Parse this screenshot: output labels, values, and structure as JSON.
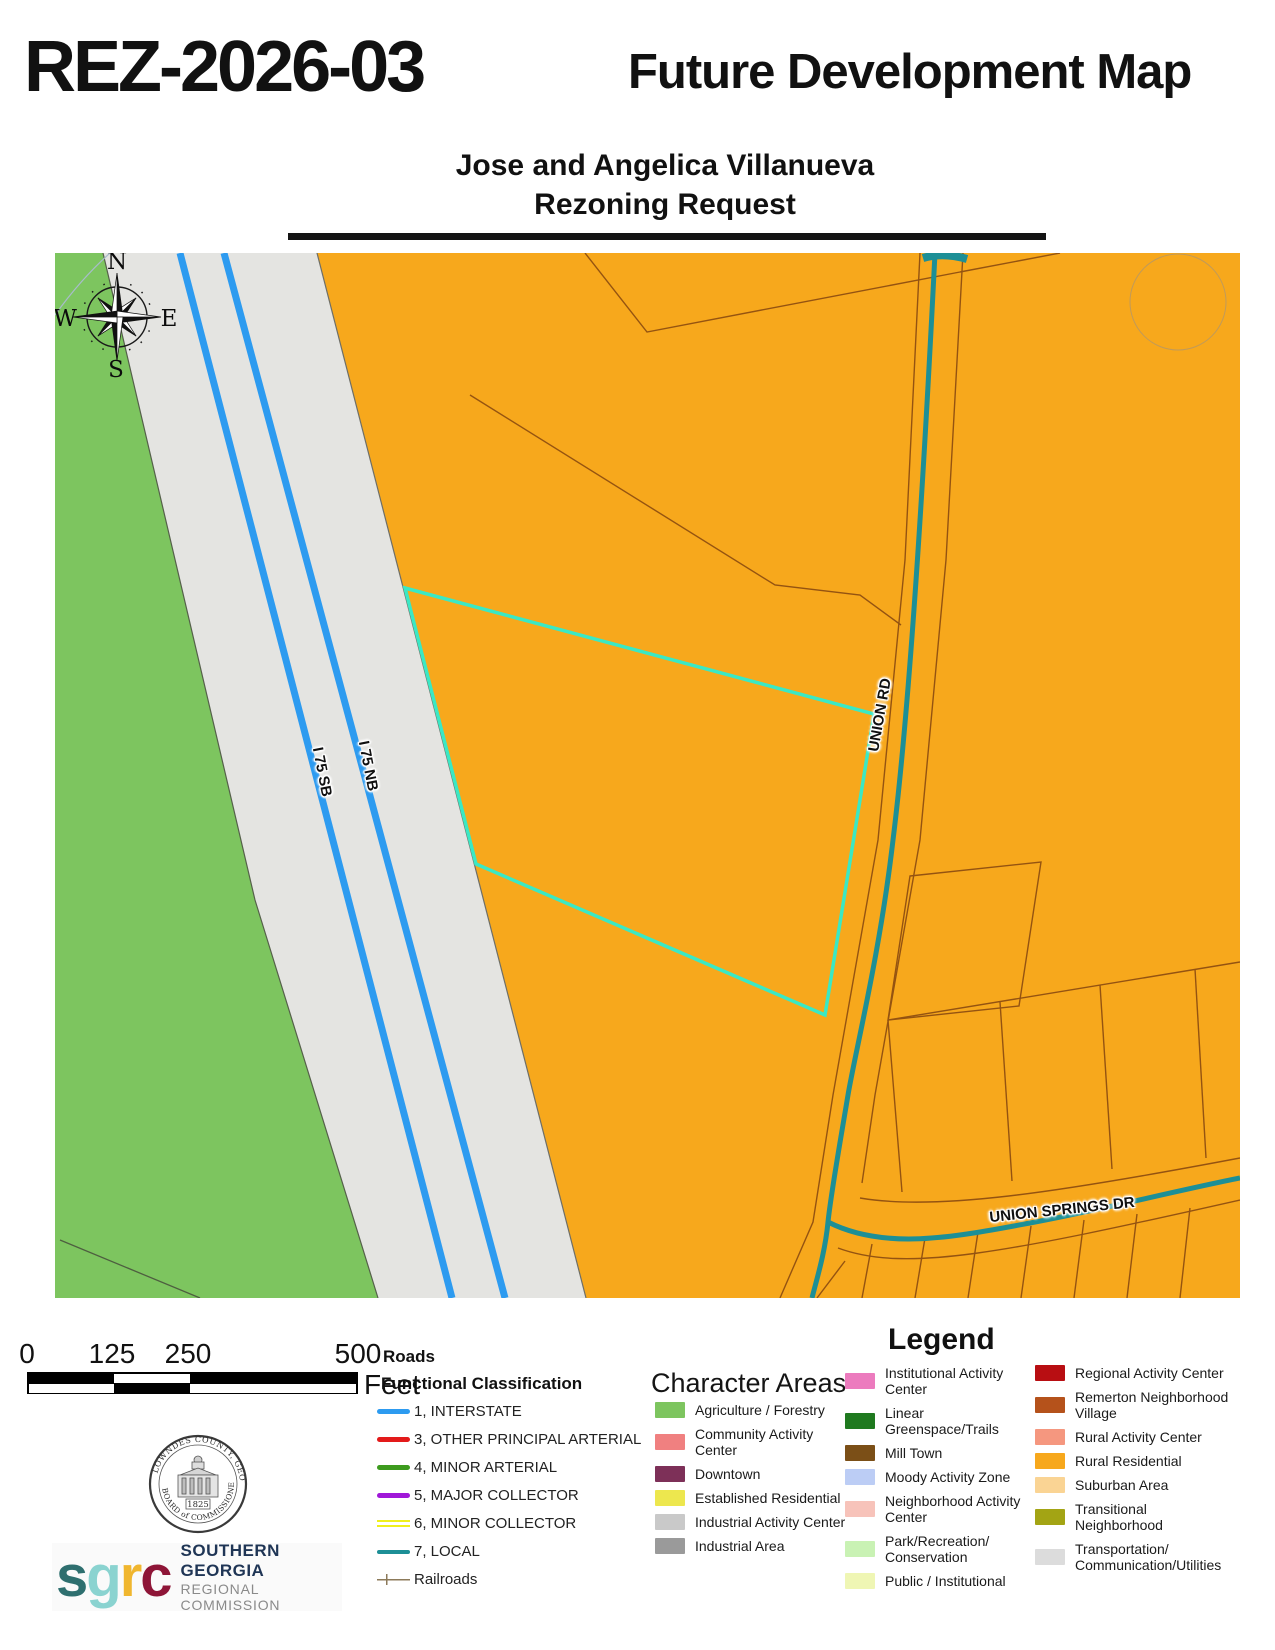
{
  "header": {
    "case_number": "REZ-2026-03",
    "map_title": "Future Development Map",
    "subtitle_line1": "Jose and Angelica Villanueva",
    "subtitle_line2": "Rezoning Request"
  },
  "map": {
    "labels": {
      "i75_sb": "I 75 SB",
      "i75_nb": "I 75 NB",
      "union_rd": "UNION RD",
      "union_springs": "UNION SPRINGS DR"
    },
    "compass": {
      "north": "N",
      "south": "S",
      "east": "E",
      "west": "W"
    },
    "colors": {
      "agriculture_green": "#7dc55f",
      "corridor_gray": "#e4e4e1",
      "rural_orange": "#f7a81c",
      "interstate_blue": "#2d9bf0",
      "local_teal": "#1d8f96",
      "parcel_highlight": "#3be8c4",
      "parcel_line_brown": "#8a4a10"
    }
  },
  "scalebar": {
    "labels": [
      "0",
      "125",
      "250",
      "500"
    ],
    "unit": "Feet"
  },
  "roads_legend": {
    "title": "Roads",
    "subtitle": "Functional Classification",
    "items": [
      {
        "label": "1, INTERSTATE",
        "css": "background:#2d9bf0;height:5px;border-radius:2.5px"
      },
      {
        "label": "3, OTHER PRINCIPAL ARTERIAL",
        "css": "background:#e31a1a;height:5px;border-radius:2.5px"
      },
      {
        "label": "4, MINOR ARTERIAL",
        "css": "background:#3d9b1e;height:5px;border-radius:2.5px"
      },
      {
        "label": "5, MAJOR COLLECTOR",
        "css": "background:#a018d8;height:5px;border-radius:2.5px"
      },
      {
        "label": "6, MINOR COLLECTOR",
        "css": "height:7px;border-top:2.5px solid #efef1d;border-bottom:2.5px solid #efef1d"
      },
      {
        "label": "7, LOCAL",
        "css": "background:#1d8f96;height:4px;border-radius:2px"
      },
      {
        "label": "Railroads",
        "css": "height:11px;background:linear-gradient(#8c7a5a,#8c7a5a) 50% 50%/100% 1.5px no-repeat,linear-gradient(#8c7a5a,#8c7a5a) 30% 50%/1.5px 11px no-repeat"
      }
    ]
  },
  "character_areas": {
    "title": "Character Areas",
    "items": [
      {
        "label": "Agriculture / Forestry",
        "color": "#7dc55f"
      },
      {
        "label": "Community Activity Center",
        "color": "#f08080"
      },
      {
        "label": "Downtown",
        "color": "#7d3058"
      },
      {
        "label": "Established Residential",
        "color": "#ede74e"
      },
      {
        "label": "Industrial Activity Center",
        "color": "#c9c9c9"
      },
      {
        "label": "Industrial Area",
        "color": "#9a9a9a"
      }
    ]
  },
  "legend": {
    "title": "Legend",
    "col1": [
      {
        "label": "Institutional Activity Center",
        "color": "#ec7bbe"
      },
      {
        "label": "Linear Greenspace/Trails",
        "color": "#1f7a1f"
      },
      {
        "label": "Mill Town",
        "color": "#7b4f17"
      },
      {
        "label": "Moody Activity Zone",
        "color": "#bccdf5"
      },
      {
        "label": "Neighborhood Activity Center",
        "color": "#f7c3ba"
      },
      {
        "label": "Park/Recreation/ Conservation",
        "color": "#c9f2b4"
      },
      {
        "label": "Public / Institutional",
        "color": "#eff6b4"
      }
    ],
    "col2": [
      {
        "label": "Regional Activity Center",
        "color": "#b80e12"
      },
      {
        "label": "Remerton Neighborhood Village",
        "color": "#b5521b"
      },
      {
        "label": "Rural Activity Center",
        "color": "#f5977f"
      },
      {
        "label": "Rural Residential",
        "color": "#f7a81c"
      },
      {
        "label": "Suburban Area",
        "color": "#fad494"
      },
      {
        "label": "Transitional Neighborhood",
        "color": "#a3a414"
      },
      {
        "label": "Transportation/ Communication/Utilities",
        "color": "#dcdcdc"
      }
    ]
  },
  "logos": {
    "seal": {
      "top_text": "LOWNDES COUNTY, GEORGIA",
      "bottom_text": "BOARD of COMMISSIONERS",
      "year": "1825"
    },
    "sgrc": {
      "letters": [
        {
          "char": "s",
          "color": "#2e6f6f"
        },
        {
          "char": "g",
          "color": "#8ad3d0"
        },
        {
          "char": "r",
          "color": "#f0b62f"
        },
        {
          "char": "c",
          "color": "#8e1537"
        }
      ],
      "line1": "SOUTHERN GEORGIA",
      "line2": "REGIONAL COMMISSION"
    }
  }
}
